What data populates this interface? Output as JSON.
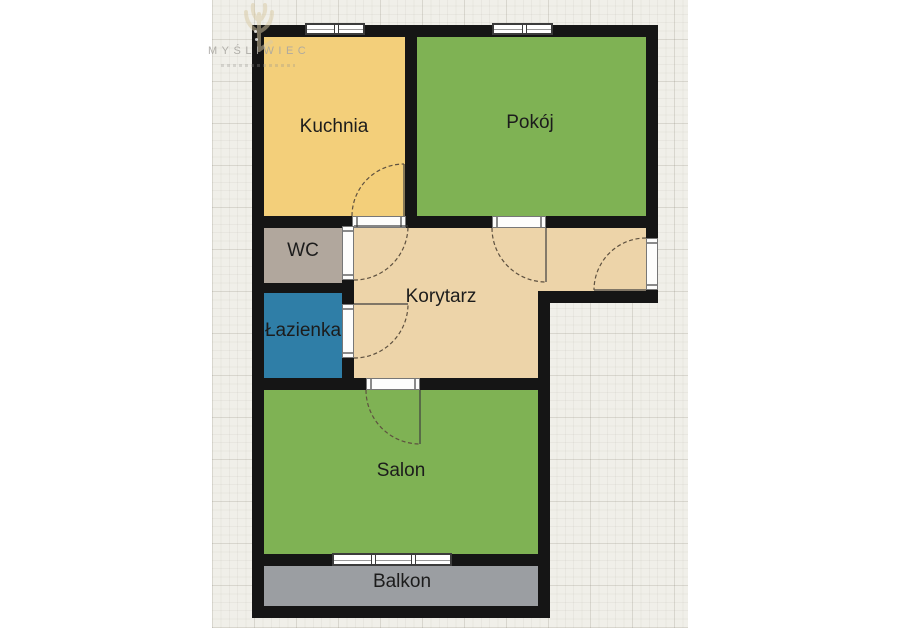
{
  "watermark": {
    "brand": "MYŚLIWIEC",
    "logo": "antlers-icon"
  },
  "rooms": {
    "kuchnia": {
      "label": "Kuchnia",
      "color": "#F3CF7A"
    },
    "pokoj": {
      "label": "Pokój",
      "color": "#7FB254"
    },
    "wc": {
      "label": "WC",
      "color": "#B1A79D"
    },
    "lazienka": {
      "label": "Łazienka",
      "color": "#2F7EA7"
    },
    "korytarz": {
      "label": "Korytarz",
      "color": "#EDD4A9"
    },
    "salon": {
      "label": "Salon",
      "color": "#7FB254"
    },
    "balkon": {
      "label": "Balkon",
      "color": "#9B9EA2"
    }
  },
  "colors": {
    "page": "#FFFFFF",
    "paper": "#F0EFE9",
    "wall": "#151515",
    "arc": "#5E5140",
    "frame": "#3C3C3C",
    "label": "#1C1C1C",
    "wm_text": "#A9A7A2",
    "wm_logo": "#DACBA4"
  }
}
